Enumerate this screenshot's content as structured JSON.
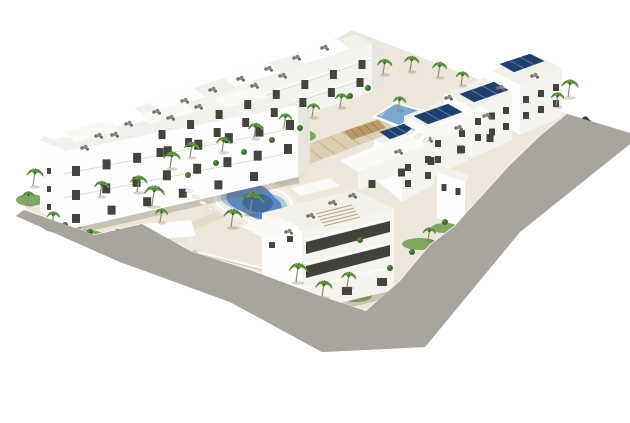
{
  "meta": {
    "description": "Aerial 3D architectural rendering of a white modern apartment complex with central lagoon pool, rectangular pool, palm trees, rooftop terraces, solar panels, perimeter road and parked cars",
    "canvas": {
      "width": 630,
      "height": 423
    },
    "background": "#ffffff"
  },
  "palette": {
    "background": "#ffffff",
    "sand": "#ece7da",
    "road": "#a9a49d",
    "lawn": "#7aa258",
    "shrub": "#3f6a31",
    "shrubLight": "#5d8b44",
    "palmTrunk": "#9b8a6b",
    "palmFrondA": "#4a7a38",
    "palmFrondB": "#6d9c50",
    "poolDeep": "#40699f",
    "poolMid": "#5e86bb",
    "poolShallow": "#a9c6e2",
    "poolRect": "#7fa9cf",
    "poolDeck": "#f3eee2",
    "white": "#fefefe",
    "face": "#f4f3ef",
    "shade": "#e5e4df",
    "roofTone": "#f1f0eb",
    "roof2": "#faf9f6",
    "windowColor": "#45443c",
    "darkBand": "#43423a",
    "solar": "#213f6e",
    "fence": "#fbfaf7",
    "furnitureGray": "#76746c",
    "shadow": "rgba(110,104,88,0.28)"
  },
  "scene": {
    "road_polygon": [
      [
        16,
        216
      ],
      [
        120,
        262
      ],
      [
        230,
        302
      ],
      [
        322,
        352
      ],
      [
        425,
        347
      ],
      [
        520,
        232
      ],
      [
        630,
        144
      ],
      [
        630,
        133
      ],
      [
        567,
        114
      ],
      [
        540,
        136
      ],
      [
        508,
        167
      ],
      [
        482,
        196
      ],
      [
        468,
        211
      ],
      [
        455,
        226
      ],
      [
        430,
        245
      ],
      [
        400,
        281
      ],
      [
        366,
        311
      ],
      [
        320,
        296
      ],
      [
        250,
        270
      ],
      [
        192,
        252
      ],
      [
        142,
        224
      ],
      [
        95,
        235
      ],
      [
        24,
        210
      ]
    ],
    "site_polygon": [
      [
        24,
        210
      ],
      [
        352,
        30
      ],
      [
        567,
        114
      ],
      [
        540,
        136
      ],
      [
        508,
        167
      ],
      [
        482,
        196
      ],
      [
        468,
        211
      ],
      [
        455,
        226
      ],
      [
        430,
        245
      ],
      [
        400,
        281
      ],
      [
        366,
        311
      ],
      [
        320,
        296
      ],
      [
        250,
        270
      ],
      [
        192,
        252
      ],
      [
        142,
        224
      ],
      [
        95,
        235
      ]
    ],
    "lawns": [
      [
        62,
        226,
        20,
        7
      ],
      [
        88,
        236,
        16,
        6
      ],
      [
        170,
        190,
        26,
        8
      ],
      [
        225,
        166,
        30,
        9
      ],
      [
        290,
        136,
        26,
        8
      ],
      [
        420,
        244,
        18,
        6
      ],
      [
        445,
        228,
        14,
        5
      ],
      [
        356,
        296,
        16,
        6
      ],
      [
        540,
        150,
        12,
        5
      ],
      [
        520,
        176,
        10,
        4
      ],
      [
        30,
        200,
        14,
        6
      ]
    ],
    "shrubs": [
      [
        118,
        232
      ],
      [
        138,
        240
      ],
      [
        158,
        248
      ],
      [
        183,
        254
      ],
      [
        208,
        264
      ],
      [
        233,
        274
      ],
      [
        258,
        284
      ],
      [
        300,
        300
      ],
      [
        338,
        308
      ],
      [
        390,
        268
      ],
      [
        412,
        252
      ],
      [
        300,
        128
      ],
      [
        272,
        140
      ],
      [
        244,
        152
      ],
      [
        216,
        163
      ],
      [
        188,
        175
      ],
      [
        350,
        96
      ],
      [
        368,
        88
      ],
      [
        470,
        214
      ],
      [
        488,
        198
      ],
      [
        506,
        180
      ],
      [
        524,
        162
      ],
      [
        360,
        240
      ],
      [
        65,
        225
      ],
      [
        445,
        222
      ],
      [
        90,
        232
      ]
    ],
    "palms": [
      [
        33,
        186,
        13,
        8
      ],
      [
        27,
        205,
        10,
        6
      ],
      [
        52,
        224,
        9,
        6
      ],
      [
        100,
        196,
        11,
        7
      ],
      [
        137,
        192,
        12,
        8
      ],
      [
        152,
        206,
        15,
        10
      ],
      [
        170,
        168,
        12,
        8
      ],
      [
        190,
        157,
        11,
        7
      ],
      [
        222,
        152,
        11,
        7
      ],
      [
        254,
        138,
        11,
        7
      ],
      [
        284,
        127,
        10,
        6
      ],
      [
        312,
        117,
        10,
        6
      ],
      [
        340,
        107,
        10,
        6
      ],
      [
        383,
        74,
        11,
        7
      ],
      [
        410,
        71,
        11,
        7
      ],
      [
        438,
        77,
        11,
        7
      ],
      [
        461,
        85,
        10,
        6
      ],
      [
        568,
        97,
        13,
        8
      ],
      [
        556,
        106,
        10,
        6
      ],
      [
        250,
        214,
        16,
        11
      ],
      [
        231,
        227,
        13,
        9
      ],
      [
        296,
        282,
        14,
        9
      ],
      [
        322,
        297,
        12,
        8
      ],
      [
        347,
        287,
        11,
        7
      ],
      [
        398,
        110,
        10,
        6
      ],
      [
        540,
        162,
        10,
        6
      ],
      [
        520,
        187,
        9,
        5
      ],
      [
        428,
        240,
        9,
        6
      ],
      [
        160,
        222,
        10,
        6
      ]
    ],
    "cars": [
      {
        "x": 127,
        "y": 239,
        "angle": 12,
        "len": 27,
        "wid": 11,
        "body": "#d9dad9",
        "glass": "#2e3134"
      },
      {
        "x": 201,
        "y": 272,
        "angle": 16,
        "len": 27,
        "wid": 11,
        "body": "#bfc1c3",
        "glass": "#2b2e31"
      },
      {
        "x": 397,
        "y": 320,
        "angle": 18,
        "len": 26,
        "wid": 11,
        "body": "#9b9ea0",
        "glass": "#26292c"
      },
      {
        "x": 428,
        "y": 290,
        "angle": 18,
        "len": 28,
        "wid": 12,
        "body": "#35393c",
        "glass": "#17191b"
      },
      {
        "x": 514,
        "y": 192,
        "angle": -43,
        "len": 27,
        "wid": 11,
        "body": "#45494d",
        "glass": "#1a1c1e"
      },
      {
        "x": 501,
        "y": 207,
        "angle": -43,
        "len": 27,
        "wid": 11,
        "body": "#c4c5c7",
        "glass": "#2d3033"
      },
      {
        "x": 566,
        "y": 144,
        "angle": -43,
        "len": 25,
        "wid": 10,
        "body": "#c0c1c3",
        "glass": "#2d3033"
      },
      {
        "x": 580,
        "y": 127,
        "angle": -43,
        "len": 24,
        "wid": 10,
        "body": "#383c40",
        "glass": "#17191b"
      }
    ],
    "roof_furniture": [
      [
        98,
        136
      ],
      [
        128,
        124
      ],
      [
        156,
        112
      ],
      [
        184,
        101
      ],
      [
        212,
        90
      ],
      [
        240,
        79
      ],
      [
        268,
        69
      ],
      [
        296,
        58
      ],
      [
        324,
        48
      ],
      [
        84,
        148
      ],
      [
        114,
        135
      ],
      [
        170,
        118
      ],
      [
        198,
        107
      ],
      [
        254,
        86
      ],
      [
        282,
        76
      ],
      [
        398,
        152
      ],
      [
        428,
        140
      ],
      [
        458,
        128
      ],
      [
        486,
        116
      ],
      [
        332,
        203
      ],
      [
        352,
        196
      ],
      [
        310,
        216
      ],
      [
        448,
        98
      ],
      [
        500,
        88
      ],
      [
        534,
        76
      ],
      [
        288,
        232
      ]
    ],
    "sun_loungers": [
      [
        189,
        191,
        16
      ],
      [
        196,
        197,
        16
      ],
      [
        203,
        203,
        16
      ],
      [
        210,
        209,
        16
      ],
      [
        410,
        132,
        -40
      ],
      [
        418,
        136,
        -40
      ],
      [
        426,
        140,
        -40
      ]
    ],
    "solar_panels": [
      [
        [
          414,
          116
        ],
        [
          448,
          104
        ],
        [
          462,
          112
        ],
        [
          428,
          124
        ]
      ],
      [
        [
          460,
          94
        ],
        [
          494,
          82
        ],
        [
          508,
          90
        ],
        [
          474,
          102
        ]
      ],
      [
        [
          500,
          64
        ],
        [
          530,
          54
        ],
        [
          544,
          61
        ],
        [
          514,
          72
        ]
      ],
      [
        [
          380,
          132
        ],
        [
          404,
          124
        ],
        [
          414,
          130
        ],
        [
          390,
          139
        ]
      ]
    ],
    "window_strips": [
      [
        162,
        130,
        362,
        60,
        8,
        7,
        9
      ],
      [
        160,
        148,
        360,
        78,
        8,
        7,
        9
      ],
      [
        76,
        166,
        290,
        120,
        8,
        8,
        10
      ],
      [
        76,
        190,
        288,
        144,
        8,
        8,
        10
      ],
      [
        76,
        214,
        254,
        172,
        6,
        8,
        9
      ],
      [
        526,
        96,
        556,
        84,
        3,
        6,
        7
      ],
      [
        526,
        112,
        556,
        100,
        3,
        6,
        7
      ],
      [
        478,
        118,
        506,
        107,
        3,
        6,
        7
      ],
      [
        478,
        134,
        506,
        123,
        3,
        6,
        7
      ],
      [
        438,
        140,
        462,
        130,
        2,
        6,
        7
      ],
      [
        438,
        156,
        462,
        146,
        2,
        6,
        7
      ],
      [
        408,
        164,
        428,
        156,
        2,
        6,
        7
      ],
      [
        408,
        180,
        428,
        172,
        2,
        6,
        7
      ],
      [
        372,
        180,
        490,
        134,
        5,
        7,
        8
      ],
      [
        312,
        296,
        382,
        278,
        3,
        10,
        8
      ],
      [
        444,
        184,
        458,
        188,
        2,
        5,
        7
      ],
      [
        49,
        168,
        49,
        204,
        3,
        4,
        6
      ],
      [
        272,
        242,
        290,
        236,
        2,
        6,
        6
      ]
    ],
    "slat_decks": [
      {
        "pts": [
          [
            292,
            150
          ],
          [
            380,
            118
          ],
          [
            398,
            130
          ],
          [
            310,
            164
          ]
        ],
        "fill": "#dbcfb4",
        "line": "#c0a97e",
        "n": 7
      },
      {
        "pts": [
          [
            344,
            131
          ],
          [
            378,
            120
          ],
          [
            386,
            128
          ],
          [
            352,
            140
          ]
        ],
        "fill": "#bb9a68",
        "line": "#94744a",
        "n": 5
      }
    ],
    "lagoon_pool": {
      "outer": "M 224 183 C 232 176 246 173 256 177 C 266 180 268 188 276 190 C 286 193 294 200 292 210 C 290 220 280 227 268 227 C 258 227 252 222 244 218 C 236 214 224 212 218 204 C 213 197 217 188 224 183 Z",
      "mid": "M 234 188 C 242 183 254 182 262 186 C 270 190 272 196 278 200 C 284 205 282 213 274 217 C 264 221 254 219 247 214 C 240 210 230 207 227 200 C 225 194 228 191 234 188 Z",
      "deep": "M 250 196 C 258 192 268 194 272 200 C 275 205 270 211 262 212 C 254 213 246 210 243 204 C 241 200 244 198 250 196 Z"
    },
    "rect_pool": {
      "rim": [
        [
          372,
          117
        ],
        [
          396,
          101
        ],
        [
          424,
          111
        ],
        [
          400,
          128
        ]
      ],
      "water": [
        [
          376,
          116
        ],
        [
          396,
          104
        ],
        [
          420,
          111
        ],
        [
          399,
          125
        ]
      ]
    }
  }
}
